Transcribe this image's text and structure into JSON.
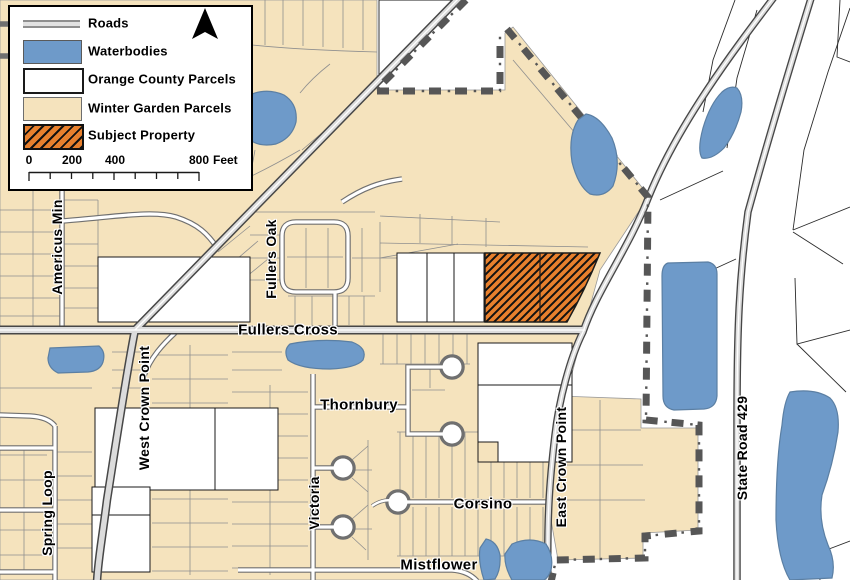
{
  "legend": {
    "items": [
      {
        "label": "Roads",
        "symbol": "road-line"
      },
      {
        "label": "Waterbodies",
        "symbol": "blue-swatch",
        "color": "#6E9AC9"
      },
      {
        "label": "Orange County Parcels",
        "symbol": "white-swatch",
        "color": "#FFFFFF"
      },
      {
        "label": "Winter Garden Parcels",
        "symbol": "tan-swatch",
        "color": "#F5E3BD"
      },
      {
        "label": "Subject Property",
        "symbol": "orange-hatch-swatch",
        "color": "#E8802D"
      }
    ],
    "scale_bar": {
      "labels": [
        "0",
        "200",
        "400",
        "800"
      ],
      "unit": "Feet"
    }
  },
  "map": {
    "street_labels": [
      {
        "text": "Fullers Cross",
        "orientation": "horizontal"
      },
      {
        "text": "Fullers Oak",
        "orientation": "vertical"
      },
      {
        "text": "Americus Min",
        "orientation": "vertical"
      },
      {
        "text": "West Crown Point",
        "orientation": "vertical"
      },
      {
        "text": "Spring Loop",
        "orientation": "vertical"
      },
      {
        "text": "Victoria",
        "orientation": "vertical"
      },
      {
        "text": "Thornbury",
        "orientation": "horizontal"
      },
      {
        "text": "Corsino",
        "orientation": "horizontal"
      },
      {
        "text": "Mistflower",
        "orientation": "horizontal"
      },
      {
        "text": "East Crown Point",
        "orientation": "vertical"
      },
      {
        "text": "State Road 429",
        "orientation": "vertical"
      }
    ],
    "colors": {
      "water": "#6E9AC9",
      "winter_garden_parcel": "#F5E3BD",
      "orange_county_parcel": "#FFFFFF",
      "subject_property": "#E8802D",
      "city_boundary": "#565656",
      "road_fill": "#DCDCDC"
    }
  }
}
